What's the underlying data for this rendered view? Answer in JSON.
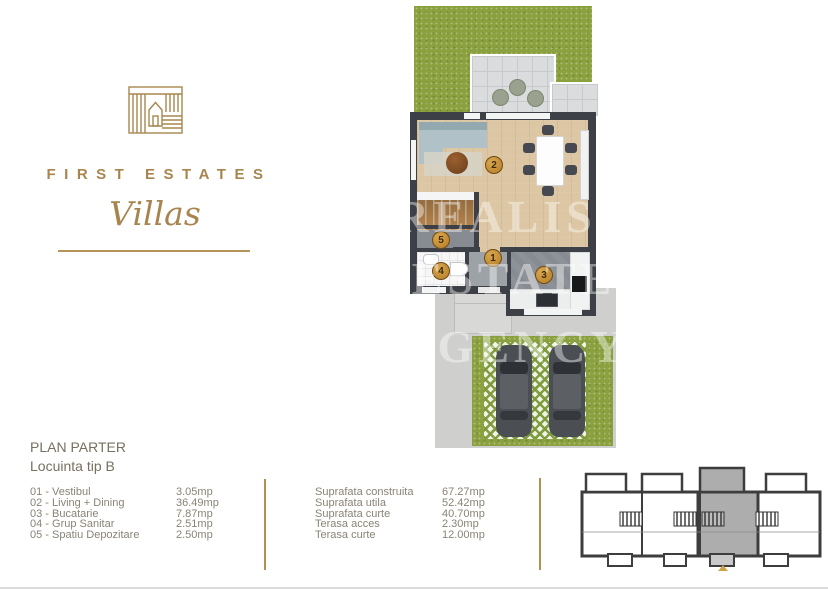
{
  "brand": {
    "name": "FIRST ESTATES",
    "tagline": "Villas"
  },
  "plan_header": {
    "title": "PLAN PARTER",
    "subtitle": "Locuinta tip B"
  },
  "legend": {
    "items": [
      {
        "label": "01 - Vestibul",
        "area": "3.05mp"
      },
      {
        "label": "02 - Living + Dining",
        "area": "36.49mp"
      },
      {
        "label": "03 - Bucatarie",
        "area": "7.87mp"
      },
      {
        "label": "04 - Grup Sanitar",
        "area": "2.51mp"
      },
      {
        "label": "05 - Spatiu Depozitare",
        "area": "2.50mp"
      }
    ]
  },
  "stats": {
    "items": [
      {
        "label": "Suprafata construita",
        "value": "67.27mp"
      },
      {
        "label": "Suprafata utila",
        "value": "52.42mp"
      },
      {
        "label": "Suprafata curte",
        "value": "40.70mp"
      },
      {
        "label": "Terasa acces",
        "value": "2.30mp"
      },
      {
        "label": "Terasa curte",
        "value": "12.00mp"
      }
    ]
  },
  "floorplan": {
    "room_numbers": {
      "vestibul": "1",
      "living": "2",
      "bucatarie": "3",
      "grup_sanitar": "4",
      "spatiu_depozitare": "5"
    },
    "watermark_lines": [
      "REALIST",
      "ESTATE",
      "AGENCY"
    ]
  },
  "colors": {
    "brand_gold": "#a8854e",
    "room_badge": "#c8963f",
    "grass": "#8ba140",
    "wall": "#3d4046",
    "wood_floor": "#dcc6a3",
    "unit_highlight": "#adadad"
  }
}
